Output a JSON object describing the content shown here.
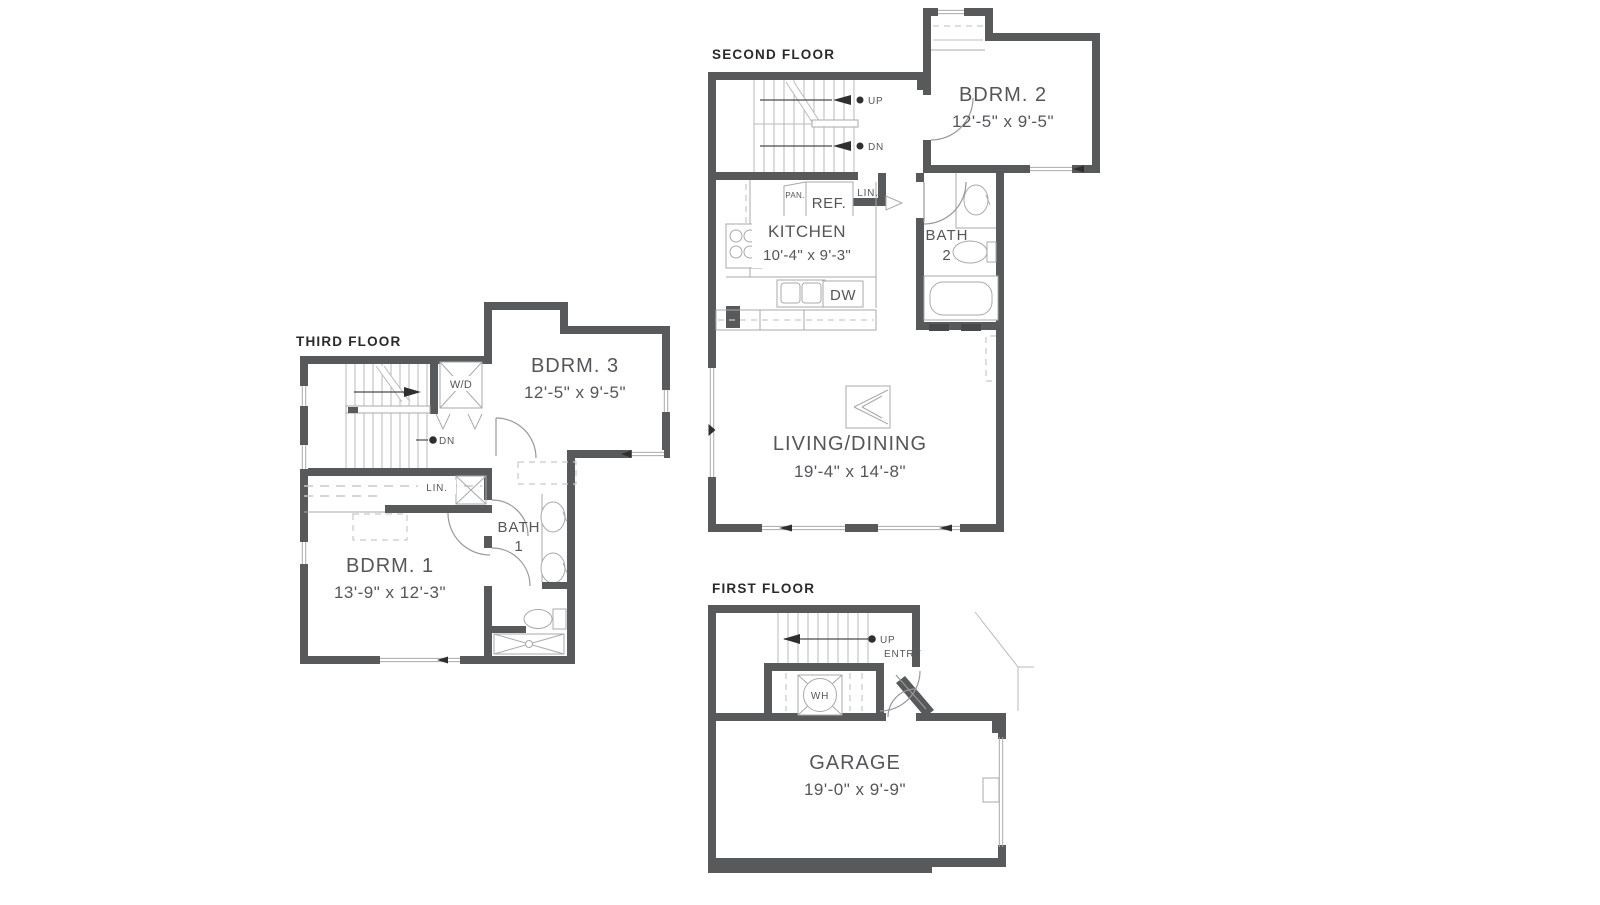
{
  "colors": {
    "wall": "#58595B",
    "title_text": "#2A2A2C",
    "label_text": "#55565A",
    "thin_line": "#A8A9AB",
    "dash_line": "#C8C9CB"
  },
  "floors": {
    "third": {
      "title": "THIRD FLOOR",
      "rooms": {
        "bdrm3": {
          "name": "BDRM. 3",
          "dims": "12'-5\" x 9'-5\""
        },
        "bdrm1": {
          "name": "BDRM. 1",
          "dims": "13'-9\" x 12'-3\""
        },
        "bath1": {
          "line1": "BATH",
          "line2": "1"
        }
      },
      "labels": {
        "wd": "W/D",
        "lin": "LIN.",
        "dn": "DN"
      }
    },
    "second": {
      "title": "SECOND FLOOR",
      "rooms": {
        "bdrm2": {
          "name": "BDRM. 2",
          "dims": "12'-5\" x 9'-5\""
        },
        "kitchen": {
          "name": "KITCHEN",
          "dims": "10'-4\" x 9'-3\""
        },
        "living": {
          "name": "LIVING/DINING",
          "dims": "19'-4\" x 14'-8\""
        },
        "bath2": {
          "line1": "BATH",
          "line2": "2"
        }
      },
      "labels": {
        "up": "UP",
        "dn": "DN",
        "ref": "REF.",
        "pan": "PAN.",
        "lin": "LIN.",
        "dw": "DW"
      }
    },
    "first": {
      "title": "FIRST FLOOR",
      "rooms": {
        "garage": {
          "name": "GARAGE",
          "dims": "19'-0\" x 9'-9\""
        }
      },
      "labels": {
        "up": "UP",
        "entry": "ENTRY",
        "wh": "WH"
      }
    }
  }
}
